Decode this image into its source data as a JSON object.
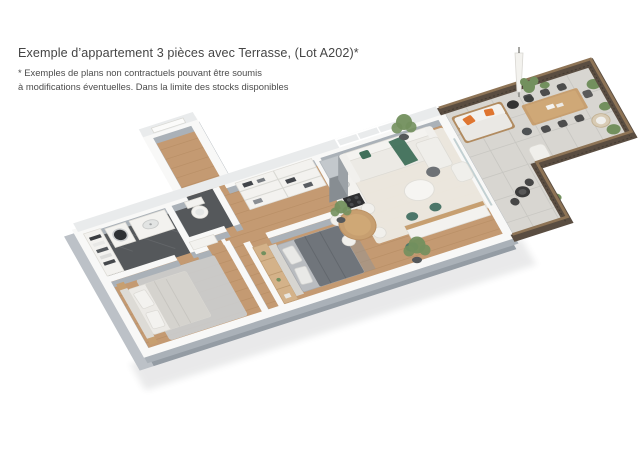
{
  "page": {
    "background": "#ffffff"
  },
  "caption": {
    "title": "Exemple d’appartement 3 pièces avec Terrasse, (Lot A202)*",
    "disclaimer_line1": "* Exemples de plans non contractuels pouvant être soumis",
    "disclaimer_line2": "à modifications éventuelles. Dans la limite des stocks disponibles"
  },
  "floorplan": {
    "type": "isometric-3d-apartment-render",
    "lot": "A202",
    "rooms": [
      {
        "name": "entrance-hall",
        "floor": "wood"
      },
      {
        "name": "bathroom",
        "floor": "dark-tile",
        "furniture": [
          "towel-shelves",
          "washing-machine",
          "vanity-sink"
        ]
      },
      {
        "name": "wc",
        "floor": "dark-tile",
        "furniture": [
          "toilet"
        ]
      },
      {
        "name": "storage-closets",
        "furniture": [
          "shelves-with-linens"
        ]
      },
      {
        "name": "bedroom-1",
        "floor": "wood",
        "furniture": [
          "double-bed",
          "rug",
          "nightstands"
        ]
      },
      {
        "name": "bedroom-2",
        "floor": "wood",
        "furniture": [
          "double-bed-dark",
          "wood-shelf-unit",
          "plant"
        ]
      },
      {
        "name": "kitchen",
        "floor": "wood",
        "furniture": [
          "tall-fridge",
          "counter-sink",
          "cooktop",
          "bar-island",
          "teal-stools"
        ]
      },
      {
        "name": "living-dining-room",
        "floor": "wood",
        "furniture": [
          "sofa",
          "green-throw",
          "coffee-tables",
          "round-dining-table",
          "chairs",
          "lounge-chair",
          "plants",
          "cream-rug"
        ]
      },
      {
        "name": "terrace",
        "floor": "pavers",
        "furniture": [
          "outdoor-sofa",
          "orange-pillows",
          "parasol",
          "outdoor-dining-table",
          "six-chairs",
          "lounge-armchair",
          "wicker-chair",
          "bistro-table",
          "planters"
        ]
      }
    ],
    "colors": {
      "background": "#ffffff",
      "text": "#474747",
      "wood_floor": "#c49a72",
      "plank_line": "#b0855c",
      "terrace_floor": "#d8d6d1",
      "paver_line": "#c6c4bf",
      "bathroom_tile": "#55585b",
      "wall_white": "#f8f8f7",
      "wall_shadow": "#aab1b8",
      "exterior_band": "#949ca4",
      "exterior_band_left": "#bcc1c7",
      "railing_dark": "#5a4d41",
      "railing_wood": "#8e7456",
      "accent_orange": "#df7530",
      "accent_teal": "#4c7669",
      "accent_green": "#40705a",
      "plant_green": "#73905e",
      "bed_dark": "#70757b",
      "rug_blue": "#cbd1d6",
      "rug_cream": "#edeae3",
      "table_wood": "#c79f70"
    }
  }
}
